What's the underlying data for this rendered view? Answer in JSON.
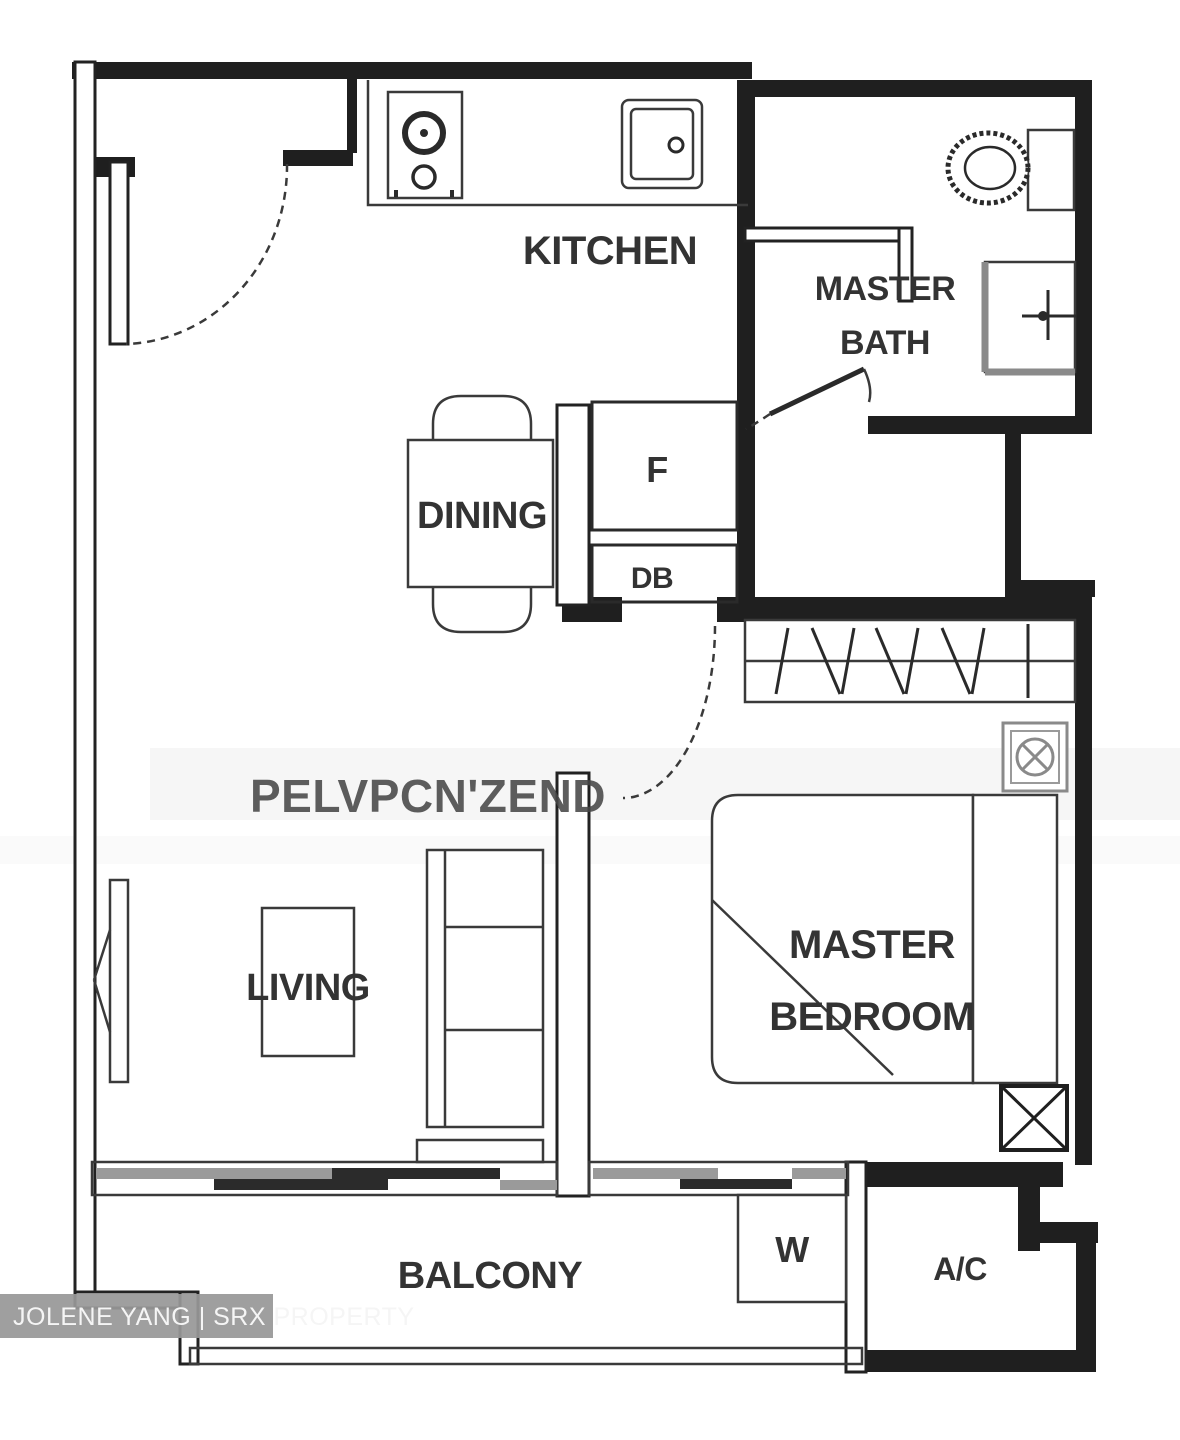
{
  "canvas": {
    "width": 1180,
    "height": 1440,
    "background": "#ffffff"
  },
  "document_type": "residential floor plan (1-bedroom unit)",
  "colors": {
    "wall": "#1f1f1f",
    "thin_line": "#3a3a3a",
    "label_text": "#333333",
    "gray_fixture": "#8a8a8a",
    "sliding_panel_dark": "#2b2b2b",
    "sliding_panel_gray": "#9a9a9a",
    "watermark_bar": "#989898",
    "watermark_text": "#f5f5f5",
    "artifact_text": "#474747"
  },
  "labels": {
    "kitchen": "KITCHEN",
    "master_bath_line1": "MASTER",
    "master_bath_line2": "BATH",
    "fridge": "F",
    "db": "DB",
    "dining": "DINING",
    "living": "LIVING",
    "master_bedroom_line1": "MASTER",
    "master_bedroom_line2": "BEDROOM",
    "balcony": "BALCONY",
    "washer": "W",
    "ac_ledge": "A/C"
  },
  "fixtures": [
    "entry-door",
    "kitchen-counter",
    "stove",
    "sink",
    "toilet",
    "shower",
    "bath-door",
    "dining-table",
    "dining-chair",
    "fridge-recess",
    "db-box",
    "bedroom-door",
    "wardrobe",
    "fan-coil-unit",
    "bed",
    "bedside-cabinet",
    "ceiling-unit-box",
    "tv",
    "coffee-table",
    "sofa",
    "sliding-doors",
    "washer-box",
    "balcony-parapet",
    "ac-ledge"
  ],
  "watermark": {
    "agent": "JOLENE YANG | SRX PROPERTY",
    "artifact": "PELVPCN'ZEND"
  }
}
